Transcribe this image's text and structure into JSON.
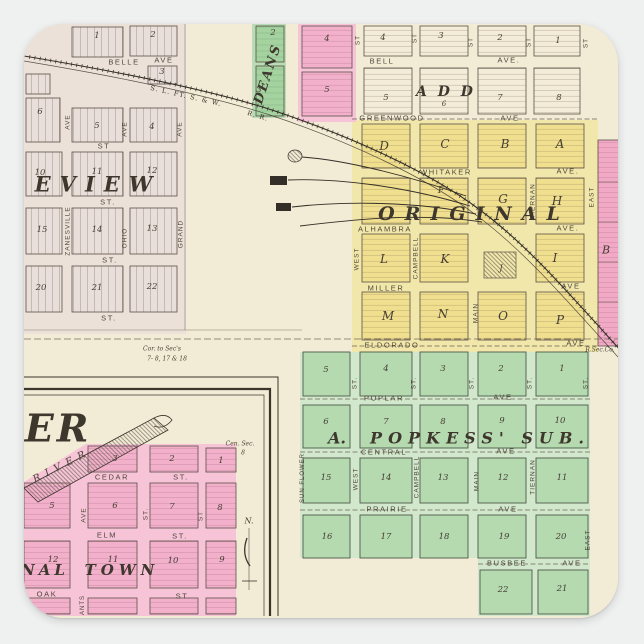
{
  "meta": {
    "description": "Square die-cut sticker of a 19th-century county atlas plat map with pink, yellow and green town additions and a railroad",
    "railroad": "S. L. FT. S. & W. R. R."
  },
  "colors": {
    "paper": "#f2ebd5",
    "upper_map_tint": "#ebe1d9",
    "yellow_addition": "#f0df8e",
    "green_addition": "#b5dab0",
    "pink_addition": "#f3b0cb",
    "deans_green": "#a5d3a0",
    "line_ink": "#5a5146",
    "background": "#eff0f0"
  },
  "labels": [
    {
      "t": "1",
      "cls": "blk",
      "x": 97,
      "y": 36
    },
    {
      "t": "2",
      "cls": "blk",
      "x": 153,
      "y": 35
    },
    {
      "t": "BELLE",
      "cls": "st",
      "x": 124,
      "y": 62,
      "n": "street-belle"
    },
    {
      "t": "AVE",
      "cls": "st",
      "x": 164,
      "y": 60
    },
    {
      "t": "3",
      "cls": "blk",
      "x": 162,
      "y": 72
    },
    {
      "t": "6",
      "cls": "blk",
      "x": 40,
      "y": 112
    },
    {
      "t": "5",
      "cls": "blk",
      "x": 97,
      "y": 126
    },
    {
      "t": "4",
      "cls": "blk",
      "x": 152,
      "y": 127
    },
    {
      "t": "AVE",
      "cls": "vst",
      "x": 68,
      "y": 122,
      "r": -90
    },
    {
      "t": "AVE",
      "cls": "vst",
      "x": 125,
      "y": 129,
      "r": -90
    },
    {
      "t": "AVE",
      "cls": "vst",
      "x": 180,
      "y": 129,
      "r": -90
    },
    {
      "t": "ST",
      "cls": "st",
      "x": 104,
      "y": 146
    },
    {
      "t": "10",
      "cls": "blk",
      "x": 40,
      "y": 173
    },
    {
      "t": "11",
      "cls": "blk",
      "x": 97,
      "y": 172
    },
    {
      "t": "12",
      "cls": "blk",
      "x": 152,
      "y": 171
    },
    {
      "t": "EVIEW",
      "cls": "big",
      "x": 98,
      "y": 184,
      "s": 21,
      "ls": 9,
      "n": "addition-name-eview"
    },
    {
      "t": "ST.",
      "cls": "st",
      "x": 108,
      "y": 202
    },
    {
      "t": "ZANESVILLE",
      "cls": "vst",
      "x": 68,
      "y": 231,
      "r": -90,
      "n": "street-zanesville"
    },
    {
      "t": "OHIO",
      "cls": "vst",
      "x": 125,
      "y": 238,
      "r": -90,
      "n": "street-ohio"
    },
    {
      "t": "GRAND",
      "cls": "vst",
      "x": 181,
      "y": 234,
      "r": -90,
      "n": "street-grand"
    },
    {
      "t": "15",
      "cls": "blk",
      "x": 42,
      "y": 230
    },
    {
      "t": "14",
      "cls": "blk",
      "x": 97,
      "y": 230
    },
    {
      "t": "13",
      "cls": "blk",
      "x": 152,
      "y": 229
    },
    {
      "t": "ST.",
      "cls": "st",
      "x": 110,
      "y": 260
    },
    {
      "t": "20",
      "cls": "blk",
      "x": 41,
      "y": 288
    },
    {
      "t": "21",
      "cls": "blk",
      "x": 97,
      "y": 288
    },
    {
      "t": "22",
      "cls": "blk",
      "x": 152,
      "y": 287
    },
    {
      "t": "ST.",
      "cls": "st",
      "x": 109,
      "y": 318
    },
    {
      "t": "S. L. FT. S. & W.",
      "cls": "rr",
      "x": 186,
      "y": 96,
      "r": 13,
      "n": "railroad-name"
    },
    {
      "t": "R. R.",
      "cls": "rr",
      "x": 258,
      "y": 116,
      "r": 17,
      "n": "railroad-name-rr"
    },
    {
      "t": "Cor. to Sec's",
      "cls": "tiny",
      "x": 162,
      "y": 349
    },
    {
      "t": "7- 8, 17 & 18",
      "cls": "tiny",
      "x": 167,
      "y": 359
    },
    {
      "t": "R.Sec.Co.",
      "cls": "tiny",
      "x": 600,
      "y": 350
    },
    {
      "t": "2",
      "cls": "blk",
      "x": 273,
      "y": 33
    },
    {
      "t": "DEANS",
      "cls": "big",
      "x": 268,
      "y": 74,
      "r": -72,
      "s": 13,
      "ls": 2,
      "n": "addition-name-deans"
    },
    {
      "t": "3",
      "cls": "blk",
      "x": 259,
      "y": 90
    },
    {
      "t": "4",
      "cls": "blk",
      "x": 327,
      "y": 39
    },
    {
      "t": "5",
      "cls": "blk",
      "x": 327,
      "y": 90
    },
    {
      "t": "ST",
      "cls": "vst",
      "x": 358,
      "y": 40,
      "r": -90
    },
    {
      "t": "4",
      "cls": "blk",
      "x": 383,
      "y": 38
    },
    {
      "t": "ST",
      "cls": "vst",
      "x": 415,
      "y": 38,
      "r": -90
    },
    {
      "t": "3",
      "cls": "blk",
      "x": 441,
      "y": 36
    },
    {
      "t": "ST",
      "cls": "vst",
      "x": 471,
      "y": 42,
      "r": -90
    },
    {
      "t": "2",
      "cls": "blk",
      "x": 500,
      "y": 38
    },
    {
      "t": "ST",
      "cls": "vst",
      "x": 529,
      "y": 42,
      "r": -90
    },
    {
      "t": "1",
      "cls": "blk",
      "x": 558,
      "y": 41
    },
    {
      "t": "ST",
      "cls": "vst",
      "x": 586,
      "y": 43,
      "r": -90
    },
    {
      "t": "BELL",
      "cls": "st",
      "x": 382,
      "y": 61,
      "n": "street-bell"
    },
    {
      "t": "AVE.",
      "cls": "st",
      "x": 509,
      "y": 60
    },
    {
      "t": "5",
      "cls": "blk",
      "x": 386,
      "y": 98
    },
    {
      "t": "A D D",
      "cls": "big",
      "x": 446,
      "y": 92,
      "s": 14,
      "ls": 3,
      "n": "addition-name-add"
    },
    {
      "t": "6",
      "cls": "blk",
      "x": 444,
      "y": 104,
      "s": 7
    },
    {
      "t": "7",
      "cls": "blk",
      "x": 500,
      "y": 98
    },
    {
      "t": "8",
      "cls": "blk",
      "x": 559,
      "y": 98
    },
    {
      "t": "GREENWOOD",
      "cls": "st",
      "x": 392,
      "y": 118,
      "n": "street-greenwood"
    },
    {
      "t": "AVE",
      "cls": "st",
      "x": 510,
      "y": 118
    },
    {
      "t": "D",
      "cls": "ltr",
      "x": 384,
      "y": 146
    },
    {
      "t": "C",
      "cls": "ltr",
      "x": 445,
      "y": 144
    },
    {
      "t": "B",
      "cls": "ltr",
      "x": 505,
      "y": 144
    },
    {
      "t": "A",
      "cls": "ltr",
      "x": 560,
      "y": 144
    },
    {
      "t": "WHITAKER",
      "cls": "st",
      "x": 446,
      "y": 172,
      "n": "street-whitaker"
    },
    {
      "t": "AVE.",
      "cls": "st",
      "x": 568,
      "y": 171
    },
    {
      "t": "F",
      "cls": "ltr",
      "x": 441,
      "y": 191,
      "s": 9
    },
    {
      "t": "G",
      "cls": "ltr",
      "x": 503,
      "y": 199
    },
    {
      "t": "H",
      "cls": "ltr",
      "x": 557,
      "y": 201
    },
    {
      "t": "TIERNAN",
      "cls": "vst",
      "x": 533,
      "y": 201,
      "r": -90,
      "n": "street-tiernan"
    },
    {
      "t": "EAST",
      "cls": "vst",
      "x": 592,
      "y": 197,
      "r": -90,
      "n": "street-east"
    },
    {
      "t": "ORIGINAL",
      "cls": "big",
      "x": 474,
      "y": 214,
      "s": 19,
      "ls": 10,
      "n": "addition-name-original"
    },
    {
      "t": "ALHAMBRA",
      "cls": "st",
      "x": 385,
      "y": 229,
      "n": "street-alhambra"
    },
    {
      "t": "AVE.",
      "cls": "st",
      "x": 568,
      "y": 228
    },
    {
      "t": "WEST",
      "cls": "vst",
      "x": 357,
      "y": 259,
      "r": -90,
      "n": "street-west"
    },
    {
      "t": "L",
      "cls": "ltr",
      "x": 384,
      "y": 259
    },
    {
      "t": "CAMPBELL",
      "cls": "vst",
      "x": 416,
      "y": 258,
      "r": -90,
      "n": "street-campbell"
    },
    {
      "t": "K",
      "cls": "ltr",
      "x": 445,
      "y": 259
    },
    {
      "t": "J",
      "cls": "ltr",
      "x": 501,
      "y": 268,
      "s": 8
    },
    {
      "t": "I",
      "cls": "ltr",
      "x": 555,
      "y": 258
    },
    {
      "t": "MILLER",
      "cls": "st",
      "x": 386,
      "y": 288,
      "n": "street-miller"
    },
    {
      "t": "AVE",
      "cls": "st",
      "x": 571,
      "y": 286
    },
    {
      "t": "M",
      "cls": "ltr",
      "x": 388,
      "y": 316
    },
    {
      "t": "N",
      "cls": "ltr",
      "x": 443,
      "y": 314
    },
    {
      "t": "MAIN",
      "cls": "vst",
      "x": 476,
      "y": 313,
      "r": -90,
      "n": "street-main"
    },
    {
      "t": "O",
      "cls": "ltr",
      "x": 503,
      "y": 316
    },
    {
      "t": "P",
      "cls": "ltr",
      "x": 560,
      "y": 320
    },
    {
      "t": "ELDORADO",
      "cls": "st",
      "x": 392,
      "y": 345,
      "n": "street-eldorado"
    },
    {
      "t": "AVE",
      "cls": "st",
      "x": 576,
      "y": 343
    },
    {
      "t": "B",
      "cls": "ltr",
      "x": 606,
      "y": 250,
      "s": 11
    },
    {
      "t": "5",
      "cls": "blk",
      "x": 326,
      "y": 370
    },
    {
      "t": "4",
      "cls": "blk",
      "x": 386,
      "y": 369
    },
    {
      "t": "3",
      "cls": "blk",
      "x": 443,
      "y": 369
    },
    {
      "t": "2",
      "cls": "blk",
      "x": 501,
      "y": 369
    },
    {
      "t": "1",
      "cls": "blk",
      "x": 562,
      "y": 369
    },
    {
      "t": "ST.",
      "cls": "vst",
      "x": 355,
      "y": 383,
      "r": -90
    },
    {
      "t": "ST.",
      "cls": "vst",
      "x": 414,
      "y": 383,
      "r": -90
    },
    {
      "t": "ST.",
      "cls": "vst",
      "x": 472,
      "y": 383,
      "r": -90
    },
    {
      "t": "ST.",
      "cls": "vst",
      "x": 530,
      "y": 383,
      "r": -90
    },
    {
      "t": "ST.",
      "cls": "vst",
      "x": 586,
      "y": 383,
      "r": -90
    },
    {
      "t": "POPLAR",
      "cls": "st",
      "x": 384,
      "y": 398,
      "n": "street-poplar"
    },
    {
      "t": "AVE",
      "cls": "st",
      "x": 503,
      "y": 397
    },
    {
      "t": "6",
      "cls": "blk",
      "x": 326,
      "y": 422
    },
    {
      "t": "7",
      "cls": "blk",
      "x": 386,
      "y": 422
    },
    {
      "t": "8",
      "cls": "blk",
      "x": 443,
      "y": 422
    },
    {
      "t": "9",
      "cls": "blk",
      "x": 502,
      "y": 421
    },
    {
      "t": "10",
      "cls": "blk",
      "x": 560,
      "y": 421
    },
    {
      "t": "A.",
      "cls": "big",
      "x": 337,
      "y": 438,
      "s": 16,
      "n": "addition-name-a"
    },
    {
      "t": "POPKESS' SUB.",
      "cls": "big",
      "x": 480,
      "y": 438,
      "s": 16,
      "ls": 6,
      "n": "addition-name-popkess-sub"
    },
    {
      "t": "CENTRAL",
      "cls": "st",
      "x": 384,
      "y": 452,
      "n": "street-central"
    },
    {
      "t": "AVE",
      "cls": "st",
      "x": 506,
      "y": 451
    },
    {
      "t": "15",
      "cls": "blk",
      "x": 326,
      "y": 478
    },
    {
      "t": "14",
      "cls": "blk",
      "x": 386,
      "y": 478
    },
    {
      "t": "13",
      "cls": "blk",
      "x": 443,
      "y": 478
    },
    {
      "t": "12",
      "cls": "blk",
      "x": 503,
      "y": 478
    },
    {
      "t": "11",
      "cls": "blk",
      "x": 562,
      "y": 478
    },
    {
      "t": "SUN FLOWER",
      "cls": "vst",
      "x": 303,
      "y": 478,
      "r": -90,
      "s": 6,
      "n": "street-sun-flower"
    },
    {
      "t": "WEST",
      "cls": "vst",
      "x": 356,
      "y": 479,
      "r": -90
    },
    {
      "t": "CAMPBELL",
      "cls": "vst",
      "x": 417,
      "y": 477,
      "r": -90
    },
    {
      "t": "MAIN",
      "cls": "vst",
      "x": 477,
      "y": 481,
      "r": -90
    },
    {
      "t": "TIERNAN",
      "cls": "vst",
      "x": 533,
      "y": 477,
      "r": -90
    },
    {
      "t": "PRAIRIE",
      "cls": "st",
      "x": 387,
      "y": 509,
      "n": "street-prairie"
    },
    {
      "t": "AVE",
      "cls": "st",
      "x": 508,
      "y": 509
    },
    {
      "t": "16",
      "cls": "blk",
      "x": 327,
      "y": 537
    },
    {
      "t": "17",
      "cls": "blk",
      "x": 386,
      "y": 537
    },
    {
      "t": "18",
      "cls": "blk",
      "x": 444,
      "y": 537
    },
    {
      "t": "19",
      "cls": "blk",
      "x": 504,
      "y": 537
    },
    {
      "t": "20",
      "cls": "blk",
      "x": 561,
      "y": 537
    },
    {
      "t": "EAST",
      "cls": "vst",
      "x": 588,
      "y": 540,
      "r": -90
    },
    {
      "t": "BUSBEE",
      "cls": "st",
      "x": 507,
      "y": 563,
      "n": "street-busbee"
    },
    {
      "t": "AVE",
      "cls": "st",
      "x": 572,
      "y": 563
    },
    {
      "t": "22",
      "cls": "blk",
      "x": 503,
      "y": 590
    },
    {
      "t": "21",
      "cls": "blk",
      "x": 562,
      "y": 589
    },
    {
      "t": "ER",
      "cls": "huge",
      "x": 58,
      "y": 428,
      "n": "inset-title-fragment-er"
    },
    {
      "t": "RIVER",
      "cls": "river",
      "x": 62,
      "y": 466,
      "r": -27,
      "n": "river-label"
    },
    {
      "t": "Cen. Sec.",
      "cls": "tiny",
      "x": 240,
      "y": 444
    },
    {
      "t": "8",
      "cls": "tiny",
      "x": 243,
      "y": 453
    },
    {
      "t": "3",
      "cls": "blk",
      "x": 115,
      "y": 459
    },
    {
      "t": "2",
      "cls": "blk",
      "x": 172,
      "y": 459
    },
    {
      "t": "1",
      "cls": "blk",
      "x": 221,
      "y": 461
    },
    {
      "t": "CEDAR",
      "cls": "st",
      "x": 112,
      "y": 477,
      "n": "street-cedar"
    },
    {
      "t": "ST.",
      "cls": "st",
      "x": 181,
      "y": 477
    },
    {
      "t": "5",
      "cls": "blk",
      "x": 52,
      "y": 506
    },
    {
      "t": "6",
      "cls": "blk",
      "x": 115,
      "y": 506
    },
    {
      "t": "7",
      "cls": "blk",
      "x": 172,
      "y": 507
    },
    {
      "t": "8",
      "cls": "blk",
      "x": 220,
      "y": 508
    },
    {
      "t": "AVE",
      "cls": "vst",
      "x": 84,
      "y": 515,
      "r": -90
    },
    {
      "t": "ST.",
      "cls": "vst",
      "x": 146,
      "y": 514,
      "r": -90
    },
    {
      "t": "ST",
      "cls": "vst",
      "x": 201,
      "y": 516,
      "r": -90
    },
    {
      "t": "ELM",
      "cls": "st",
      "x": 107,
      "y": 535,
      "n": "street-elm"
    },
    {
      "t": "ST.",
      "cls": "st",
      "x": 180,
      "y": 536
    },
    {
      "t": "12",
      "cls": "blk",
      "x": 53,
      "y": 560
    },
    {
      "t": "11",
      "cls": "blk",
      "x": 113,
      "y": 560
    },
    {
      "t": "10",
      "cls": "blk",
      "x": 173,
      "y": 561
    },
    {
      "t": "9",
      "cls": "blk",
      "x": 222,
      "y": 560
    },
    {
      "t": "NAL",
      "cls": "big",
      "x": 45,
      "y": 570,
      "s": 15,
      "ls": 4,
      "n": "inset-name-nal"
    },
    {
      "t": "TOWN",
      "cls": "big",
      "x": 122,
      "y": 570,
      "s": 15,
      "ls": 5,
      "n": "inset-name-town"
    },
    {
      "t": "OAK",
      "cls": "st",
      "x": 47,
      "y": 594,
      "n": "street-oak"
    },
    {
      "t": "ST",
      "cls": "st",
      "x": 182,
      "y": 596
    },
    {
      "t": "ANTS",
      "cls": "vst",
      "x": 83,
      "y": 605,
      "r": -90,
      "s": 6,
      "n": "street-ants-fragment"
    },
    {
      "t": "N.",
      "cls": "tiny",
      "x": 249,
      "y": 521,
      "s": 8,
      "n": "north-indicator-label"
    }
  ]
}
